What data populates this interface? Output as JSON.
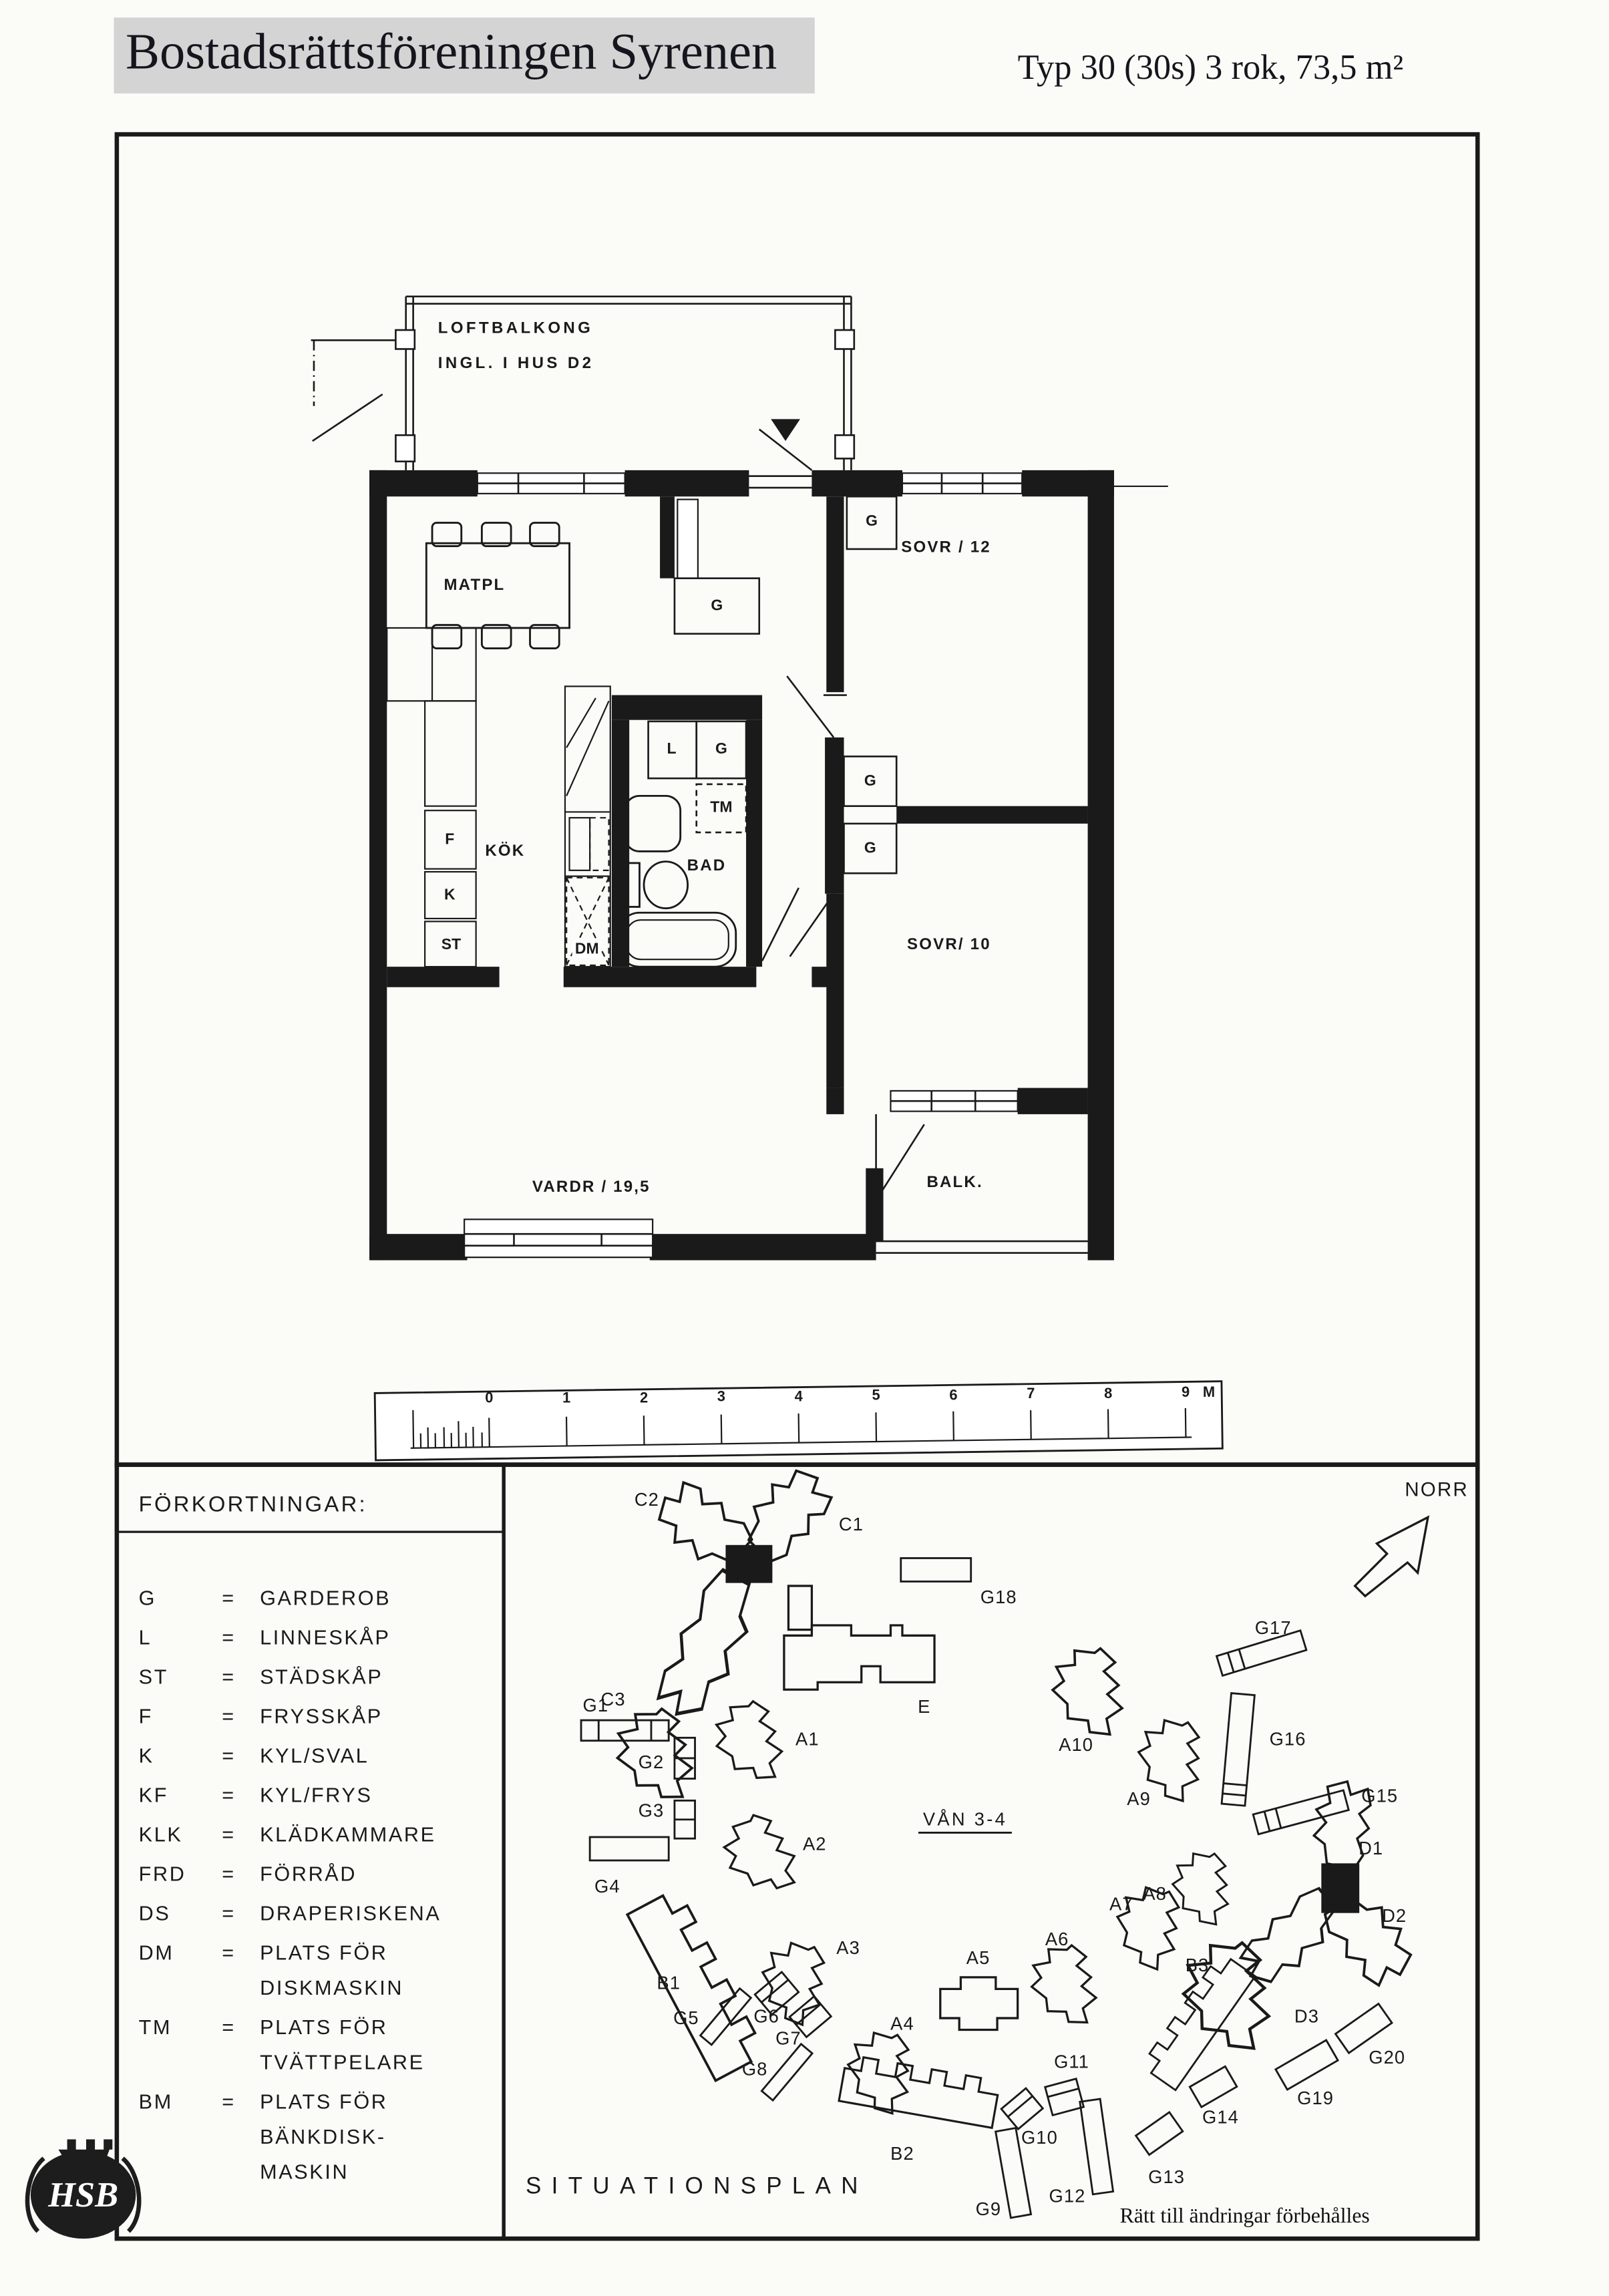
{
  "colors": {
    "ink": "#1a1a1a",
    "paper": "#fbfbf8",
    "title_bg": "#d4d4d4"
  },
  "header": {
    "title": "Bostadsrättsföreningen Syrenen",
    "type_label": "Typ 30 (30s) 3 rok, 73,5 m²"
  },
  "floor_plan": {
    "balcony_note_line1": "LOFTBALKONG",
    "balcony_note_line2": "INGL. I HUS D2",
    "rooms": {
      "matpl": "MATPL",
      "kok": "KÖK",
      "bad": "BAD",
      "sovr12": "SOVR / 12",
      "sovr10": "SOVR/ 10",
      "vardr": "VARDR / 19,5",
      "balk": "BALK."
    },
    "closets": {
      "g": "G",
      "l": "L",
      "tm": "TM",
      "f": "F",
      "k": "K",
      "st": "ST",
      "dm": "DM"
    }
  },
  "ruler": {
    "marks": [
      "0",
      "1",
      "2",
      "3",
      "4",
      "5",
      "6",
      "7",
      "8",
      "9"
    ],
    "unit": "M"
  },
  "legend": {
    "title": "FÖRKORTNINGAR:",
    "lines": [
      {
        "abbr": "G",
        "eq": "=",
        "text": "GARDEROB"
      },
      {
        "abbr": "L",
        "eq": "=",
        "text": "LINNESKÅP"
      },
      {
        "abbr": "ST",
        "eq": "=",
        "text": "STÄDSKÅP"
      },
      {
        "abbr": "F",
        "eq": "=",
        "text": "FRYSSKÅP"
      },
      {
        "abbr": "K",
        "eq": "=",
        "text": "KYL/SVAL"
      },
      {
        "abbr": "KF",
        "eq": "=",
        "text": "KYL/FRYS"
      },
      {
        "abbr": "KLK",
        "eq": "=",
        "text": "KLÄDKAMMARE"
      },
      {
        "abbr": "FRD",
        "eq": "=",
        "text": "FÖRRÅD"
      },
      {
        "abbr": "DS",
        "eq": "=",
        "text": "DRAPERISKENA"
      },
      {
        "abbr": "DM",
        "eq": "=",
        "text": "PLATS FÖR"
      },
      {
        "abbr": "",
        "eq": "",
        "text": "DISKMASKIN"
      },
      {
        "abbr": "TM",
        "eq": "=",
        "text": "PLATS FÖR"
      },
      {
        "abbr": "",
        "eq": "",
        "text": "TVÄTTPELARE"
      },
      {
        "abbr": "BM",
        "eq": "=",
        "text": "PLATS FÖR"
      },
      {
        "abbr": "",
        "eq": "",
        "text": "BÄNKDISK-"
      },
      {
        "abbr": "",
        "eq": "",
        "text": "MASKIN"
      }
    ]
  },
  "siteplan": {
    "title": "SITUATIONSPLAN",
    "north_label": "NORR",
    "floor_note": "VÅN 3-4",
    "disclaimer": "Rätt till ändringar förbehålles",
    "buildings": {
      "c1": "C1",
      "c2": "C2",
      "c3": "C3",
      "e": "E",
      "a1": "A1",
      "a2": "A2",
      "a3": "A3",
      "a4": "A4",
      "a5": "A5",
      "a6": "A6",
      "a7": "A7",
      "a8": "A8",
      "a9": "A9",
      "a10": "A10",
      "b1": "B1",
      "b2": "B2",
      "b3": "B3",
      "d1": "D1",
      "d2": "D2",
      "d3": "D3",
      "g1": "G1",
      "g2": "G2",
      "g3": "G3",
      "g4": "G4",
      "g5": "G5",
      "g6": "G6",
      "g7": "G7",
      "g8": "G8",
      "g9": "G9",
      "g10": "G10",
      "g11": "G11",
      "g12": "G12",
      "g13": "G13",
      "g14": "G14",
      "g15": "G15",
      "g16": "G16",
      "g17": "G17",
      "g18": "G18",
      "g19": "G19",
      "g20": "G20"
    }
  },
  "logo": {
    "text": "HSB"
  }
}
